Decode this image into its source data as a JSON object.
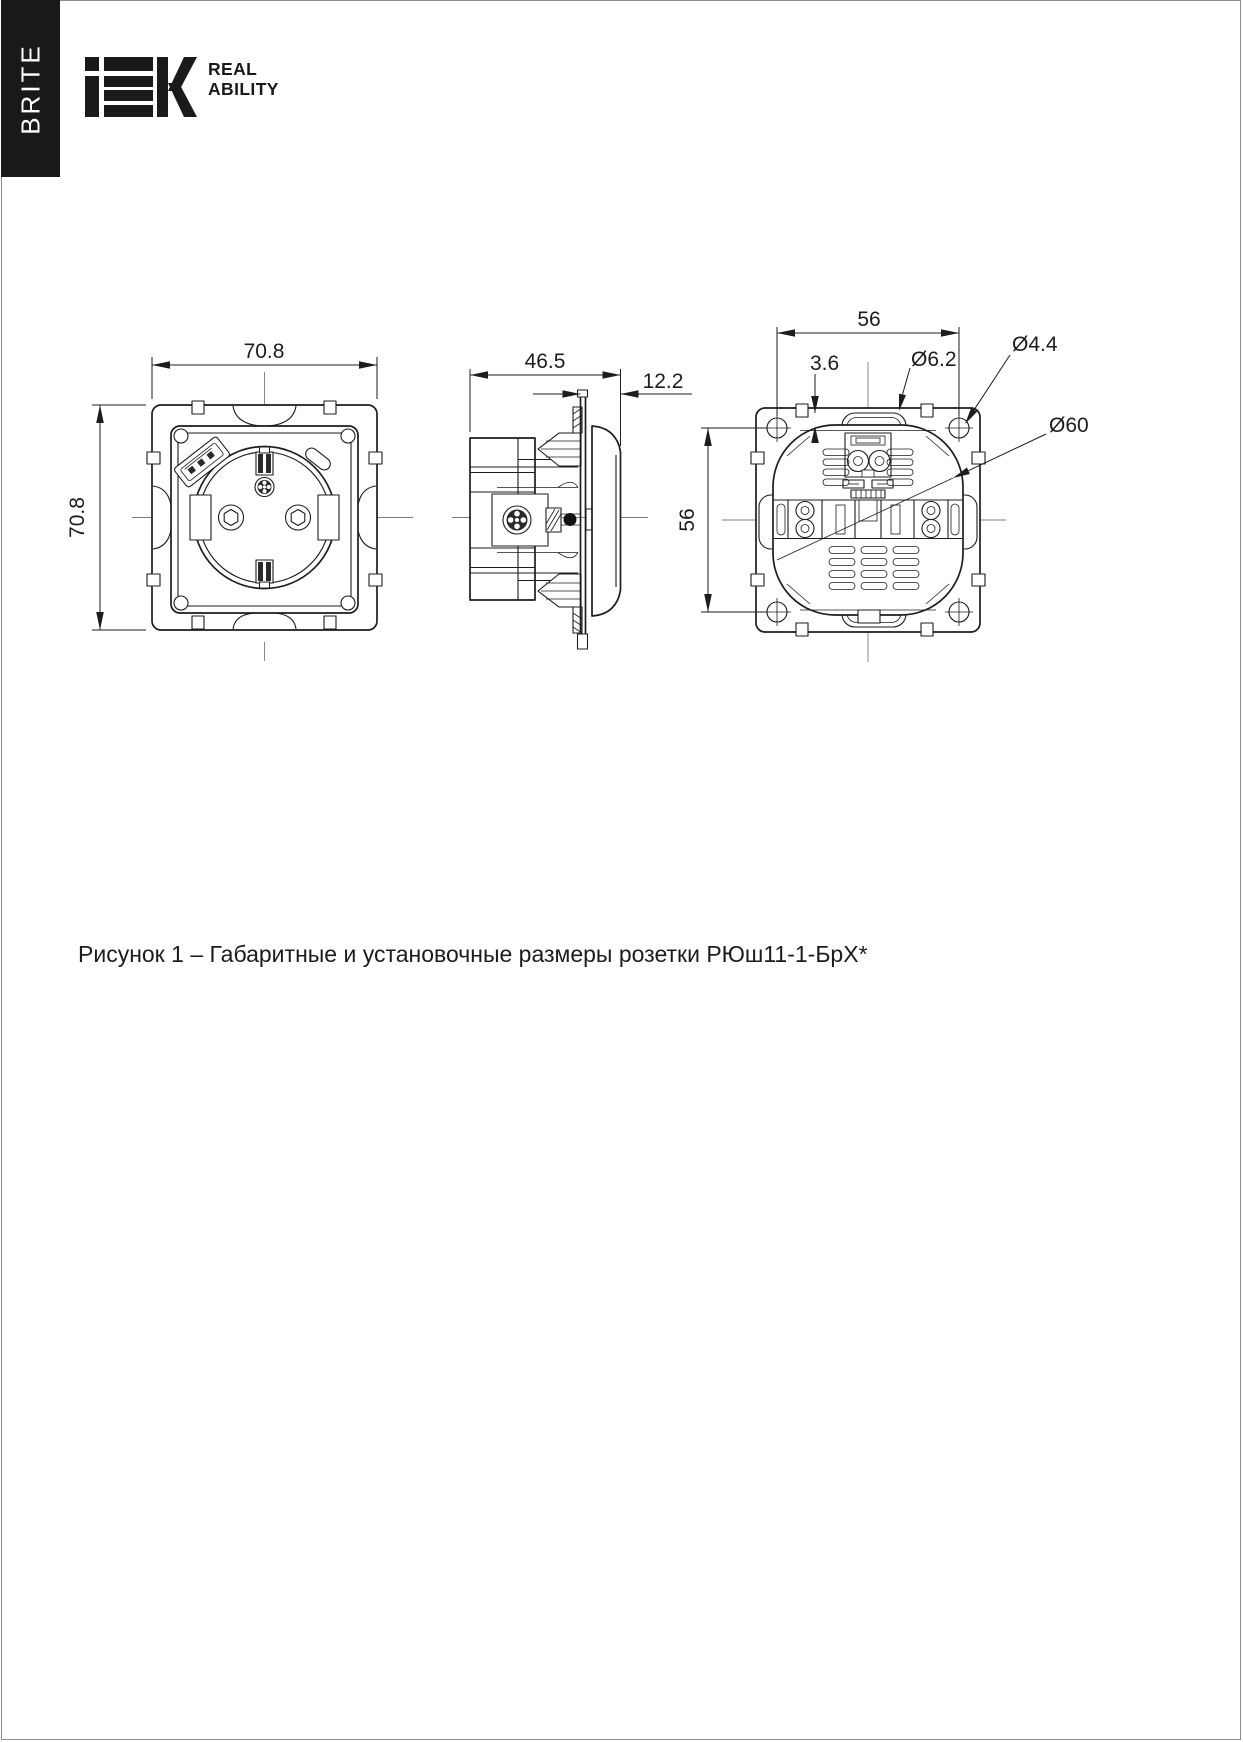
{
  "header": {
    "series_tab": "BRITE",
    "logo_text": "IEK",
    "tagline_line1": "REAL",
    "tagline_line2": "ABILITY"
  },
  "figure": {
    "caption": "Рисунок 1 – Габаритные и установочные размеры розетки РЮш11-1-БрХ*",
    "views": {
      "front": {
        "width": "70.8",
        "height": "70.8"
      },
      "side": {
        "depth": "46.5",
        "cover_depth": "12.2"
      },
      "back": {
        "mount_hole_spacing_h": "56",
        "mount_hole_spacing_v": "56",
        "lobe_protrusion": "3.6",
        "lobe_diameter": "Ø6.2",
        "mount_hole_diameter": "Ø4.4",
        "body_diameter": "Ø60"
      }
    }
  },
  "colors": {
    "ink": "#1d1d1d",
    "centerline": "#7c7c7c",
    "tab_background": "#191919",
    "page_border": "#8f8f8f"
  }
}
